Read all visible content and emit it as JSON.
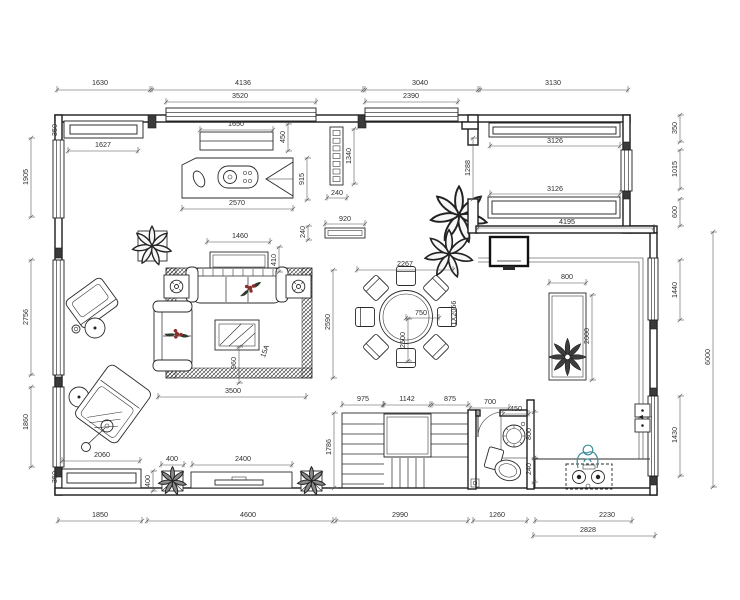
{
  "meta": {
    "type": "residential floor plan drawing",
    "units": "mm"
  },
  "colors": {
    "line": "#1f1f1f",
    "dim_text": "#2e2e2e",
    "dim_line": "#4a4a4a",
    "accent_bloom": "#8b2e2e",
    "person": "#3f8e9b",
    "paper": "#ffffff"
  },
  "items": [
    "study-desk",
    "wall-shelf",
    "bay-window",
    "screen-divider",
    "console-table",
    "potted-plant",
    "sofa-main",
    "sofa-left",
    "side-table-lamp-left",
    "side-table-lamp-right",
    "coffee-table",
    "area-rug",
    "armchair",
    "round-side-table",
    "chaise-lounge",
    "floor-lamp",
    "dining-table-round",
    "dining-chairs-8",
    "dining-plants",
    "wall-tv",
    "kitchen-island",
    "island-flower-decor",
    "double-sink",
    "gas-stove",
    "person-figure",
    "staircase-with-landing",
    "bathroom-door",
    "washbasin",
    "toilet",
    "floor-drain",
    "window-seat",
    "planter-box-left",
    "tv-console",
    "planter-box-right"
  ],
  "dimensions": [
    {
      "t": "1630",
      "x": 100,
      "y": 85,
      "l": 90,
      "s": 57,
      "e": 150
    },
    {
      "t": "4136",
      "x": 243,
      "y": 85,
      "l": 90,
      "s": 152,
      "e": 363
    },
    {
      "t": "3040",
      "x": 420,
      "y": 85,
      "l": 90,
      "s": 365,
      "e": 478
    },
    {
      "t": "3130",
      "x": 553,
      "y": 85,
      "l": 90,
      "s": 480,
      "e": 628
    },
    {
      "t": "3520",
      "x": 240,
      "y": 98,
      "l": 102,
      "s": 166,
      "e": 316
    },
    {
      "t": "2390",
      "x": 411,
      "y": 98,
      "l": 102,
      "s": 365,
      "e": 458
    },
    {
      "t": "1650",
      "x": 236,
      "y": 126,
      "l": 130,
      "s": 200,
      "e": 273
    },
    {
      "t": "1627",
      "x": 103,
      "y": 147,
      "l": 151,
      "s": 68,
      "e": 138
    },
    {
      "t": "2570",
      "x": 237,
      "y": 205,
      "l": 209,
      "s": 182,
      "e": 293
    },
    {
      "t": "240",
      "x": 337,
      "y": 195,
      "l": 198,
      "s": 327,
      "e": 347
    },
    {
      "t": "920",
      "x": 345,
      "y": 221,
      "l": 224,
      "s": 325,
      "e": 365
    },
    {
      "t": "3126",
      "x": 555,
      "y": 143,
      "l": 146,
      "s": 490,
      "e": 620
    },
    {
      "t": "3126",
      "x": 555,
      "y": 191,
      "l": 194,
      "s": 490,
      "e": 620
    },
    {
      "t": "4195",
      "x": 567,
      "y": 224,
      "l": 228,
      "s": 478,
      "e": 654
    },
    {
      "t": "1460",
      "x": 240,
      "y": 238,
      "l": 242,
      "s": 207,
      "e": 270
    },
    {
      "t": "3500",
      "x": 233,
      "y": 393,
      "l": 397,
      "s": 158,
      "e": 306
    },
    {
      "t": "2267",
      "x": 405,
      "y": 266,
      "l": 270,
      "s": 357,
      "e": 453
    },
    {
      "t": "750",
      "x": 421,
      "y": 315,
      "l": 318,
      "s": 406,
      "e": 439
    },
    {
      "t": "800",
      "x": 567,
      "y": 279,
      "l": 283,
      "s": 549,
      "e": 586
    },
    {
      "t": "975",
      "x": 363,
      "y": 401,
      "l": 405,
      "s": 342,
      "e": 383
    },
    {
      "t": "1142",
      "x": 407,
      "y": 401,
      "l": 405,
      "s": 384,
      "e": 430
    },
    {
      "t": "875",
      "x": 450,
      "y": 401,
      "l": 405,
      "s": 432,
      "e": 468
    },
    {
      "t": "700",
      "x": 490,
      "y": 404,
      "l": 408,
      "s": 470,
      "e": 509
    },
    {
      "t": "450",
      "x": 516,
      "y": 411,
      "l": 414,
      "s": 503,
      "e": 529
    },
    {
      "t": "2060",
      "x": 102,
      "y": 457,
      "l": 461,
      "s": 62,
      "e": 140
    },
    {
      "t": "400",
      "x": 172,
      "y": 461,
      "l": 465,
      "s": 161,
      "e": 184
    },
    {
      "t": "2400",
      "x": 243,
      "y": 461,
      "l": 465,
      "s": 192,
      "e": 292
    },
    {
      "t": "1850",
      "x": 100,
      "y": 517,
      "l": 521,
      "s": 58,
      "e": 142
    },
    {
      "t": "4600",
      "x": 248,
      "y": 517,
      "l": 521,
      "s": 147,
      "e": 333
    },
    {
      "t": "2990",
      "x": 400,
      "y": 517,
      "l": 521,
      "s": 336,
      "e": 468
    },
    {
      "t": "1260",
      "x": 497,
      "y": 517,
      "l": 521,
      "s": 473,
      "e": 527
    },
    {
      "t": "2230",
      "x": 607,
      "y": 517,
      "l": 521,
      "s": 535,
      "e": 632
    },
    {
      "t": "2828",
      "x": 588,
      "y": 532,
      "l": 536,
      "s": 533,
      "e": 655
    },
    {
      "t": "350",
      "x": 57,
      "y": 130,
      "r": 1
    },
    {
      "t": "1905",
      "x": 28,
      "y": 177,
      "r": 1,
      "l": 31,
      "s": 138,
      "e": 217
    },
    {
      "t": "2756",
      "x": 28,
      "y": 317,
      "r": 1,
      "l": 31,
      "s": 260,
      "e": 375
    },
    {
      "t": "1860",
      "x": 28,
      "y": 422,
      "r": 1,
      "l": 31,
      "s": 387,
      "e": 467
    },
    {
      "t": "350",
      "x": 57,
      "y": 477,
      "r": 1
    },
    {
      "t": "450",
      "x": 285,
      "y": 137,
      "r": 1,
      "l": 288,
      "s": 124,
      "e": 151
    },
    {
      "t": "915",
      "x": 304,
      "y": 179,
      "r": 1,
      "l": 307,
      "s": 158,
      "e": 200
    },
    {
      "t": "1340",
      "x": 351,
      "y": 156,
      "r": 1,
      "l": 354,
      "s": 129,
      "e": 184
    },
    {
      "t": "240",
      "x": 305,
      "y": 232,
      "r": 1,
      "l": 308,
      "s": 226,
      "e": 240
    },
    {
      "t": "1288",
      "x": 470,
      "y": 168,
      "r": 1,
      "l": 473,
      "s": 138,
      "e": 199
    },
    {
      "t": "410",
      "x": 276,
      "y": 260,
      "r": 1,
      "l": 279,
      "s": 247,
      "e": 272
    },
    {
      "t": "2590",
      "x": 330,
      "y": 322,
      "r": 1,
      "l": 333,
      "s": 270,
      "e": 378
    },
    {
      "t": "960",
      "x": 236,
      "y": 363,
      "r": 1,
      "l": 239,
      "s": 347,
      "e": 383
    },
    {
      "t": "2500",
      "x": 405,
      "y": 340,
      "r": 1,
      "l": 408,
      "s": 319,
      "e": 361
    },
    {
      "t": "2000",
      "x": 589,
      "y": 336,
      "r": 1,
      "l": 592,
      "s": 295,
      "e": 380
    },
    {
      "t": "350",
      "x": 677,
      "y": 128,
      "r": 1,
      "l": 680,
      "s": 115,
      "e": 142
    },
    {
      "t": "1015",
      "x": 677,
      "y": 169,
      "r": 1,
      "l": 680,
      "s": 150,
      "e": 189
    },
    {
      "t": "600",
      "x": 677,
      "y": 212,
      "r": 1,
      "l": 680,
      "s": 199,
      "e": 226
    },
    {
      "t": "1440",
      "x": 677,
      "y": 290,
      "r": 1,
      "l": 680,
      "s": 260,
      "e": 320
    },
    {
      "t": "1430",
      "x": 677,
      "y": 435,
      "r": 1,
      "l": 680,
      "s": 396,
      "e": 476
    },
    {
      "t": "6000",
      "x": 710,
      "y": 357,
      "r": 1,
      "l": 713,
      "s": 232,
      "e": 487
    },
    {
      "t": "1786",
      "x": 331,
      "y": 447,
      "r": 1,
      "l": 334,
      "s": 413,
      "e": 488
    },
    {
      "t": "800",
      "x": 531,
      "y": 434,
      "r": 1,
      "l": 534,
      "s": 412,
      "e": 458
    },
    {
      "t": "240",
      "x": 531,
      "y": 469,
      "r": 1,
      "l": 534,
      "s": 458,
      "e": 482
    },
    {
      "t": "400",
      "x": 150,
      "y": 481,
      "r": 1,
      "l": 153,
      "s": 471,
      "e": 491
    }
  ],
  "annotations": [
    {
      "t": "15A",
      "x": 267,
      "y": 352,
      "a": -70,
      "fs": 6.2
    },
    {
      "t": "1X2066",
      "x": 456,
      "y": 313,
      "a": -90,
      "fs": 6.2
    }
  ]
}
